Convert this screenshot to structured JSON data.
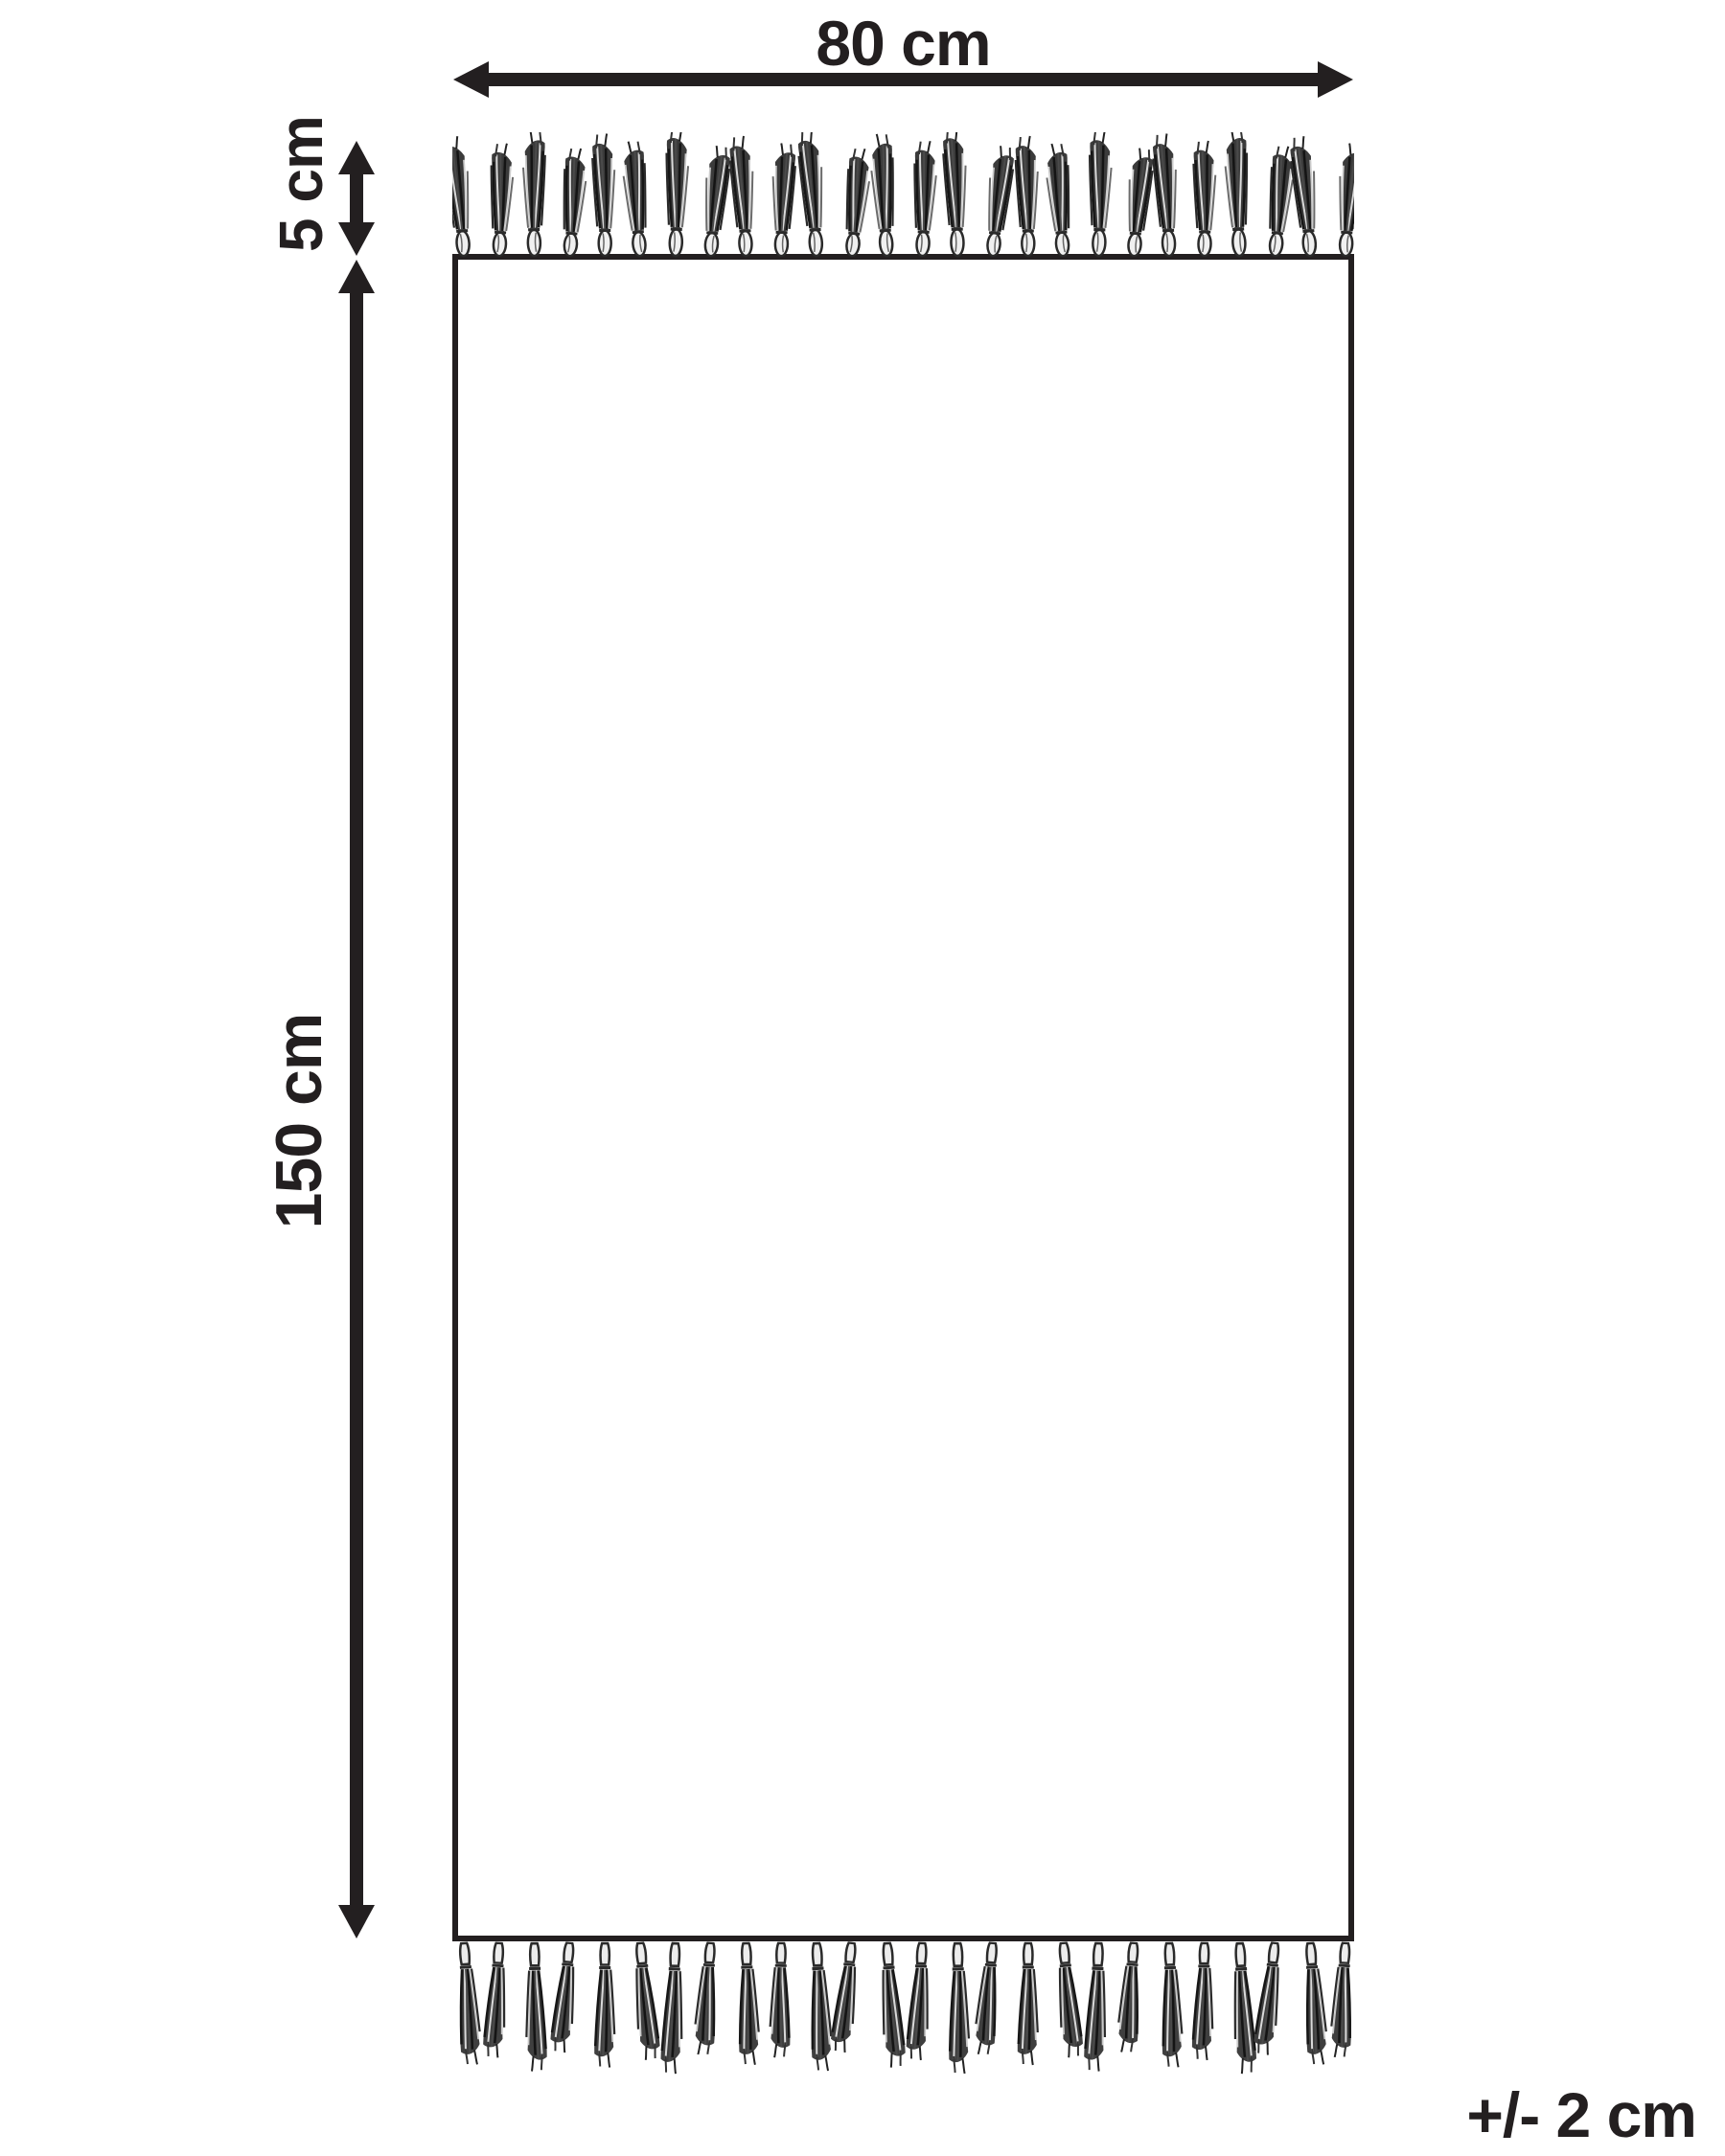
{
  "diagram": {
    "kind": "rug-dimension-diagram",
    "background_color": "#ffffff",
    "ink_color": "#231f20",
    "labels": {
      "width": "80 cm",
      "fringe_height": "5 cm",
      "length": "150 cm",
      "tolerance": "+/- 2 cm"
    },
    "dimensions_cm": {
      "width": 80,
      "length": 150,
      "fringe": 5,
      "tolerance": 2
    },
    "fringe": {
      "rows": [
        {
          "position": "top",
          "count": 26
        },
        {
          "position": "bottom",
          "count": 26
        }
      ]
    }
  }
}
